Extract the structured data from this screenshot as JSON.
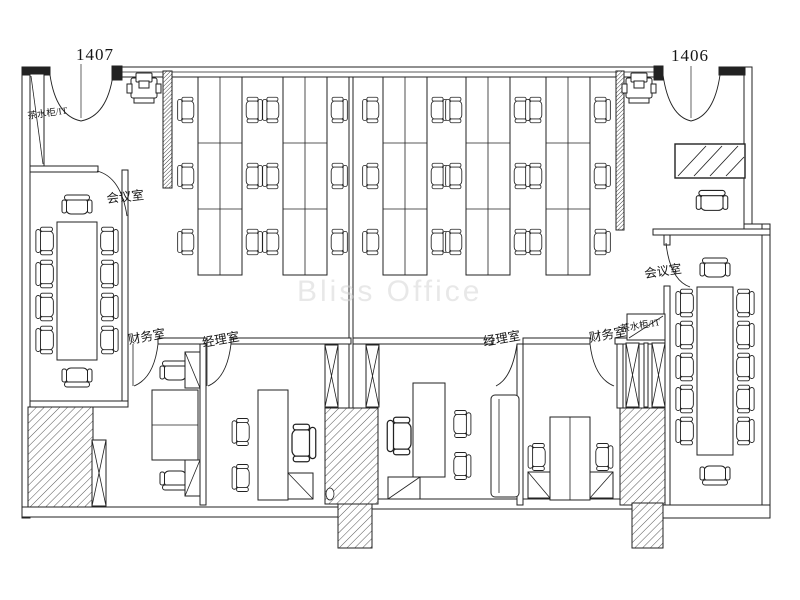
{
  "watermark": "Bliss Office",
  "door_numbers": {
    "left": "1407",
    "right": "1406"
  },
  "labels": {
    "meeting_room_left": "会议室",
    "meeting_room_right": "会议室",
    "finance_room_left": "财务室",
    "finance_room_right": "财务室",
    "manager_room_left": "经理室",
    "manager_room_right": "经理室",
    "tea_cabinet_left": "茶水柜/IT",
    "tea_cabinet_right": "茶水柜/IT"
  },
  "colors": {
    "line": "#222222",
    "background": "#ffffff",
    "watermark": "#d7d7d7"
  }
}
